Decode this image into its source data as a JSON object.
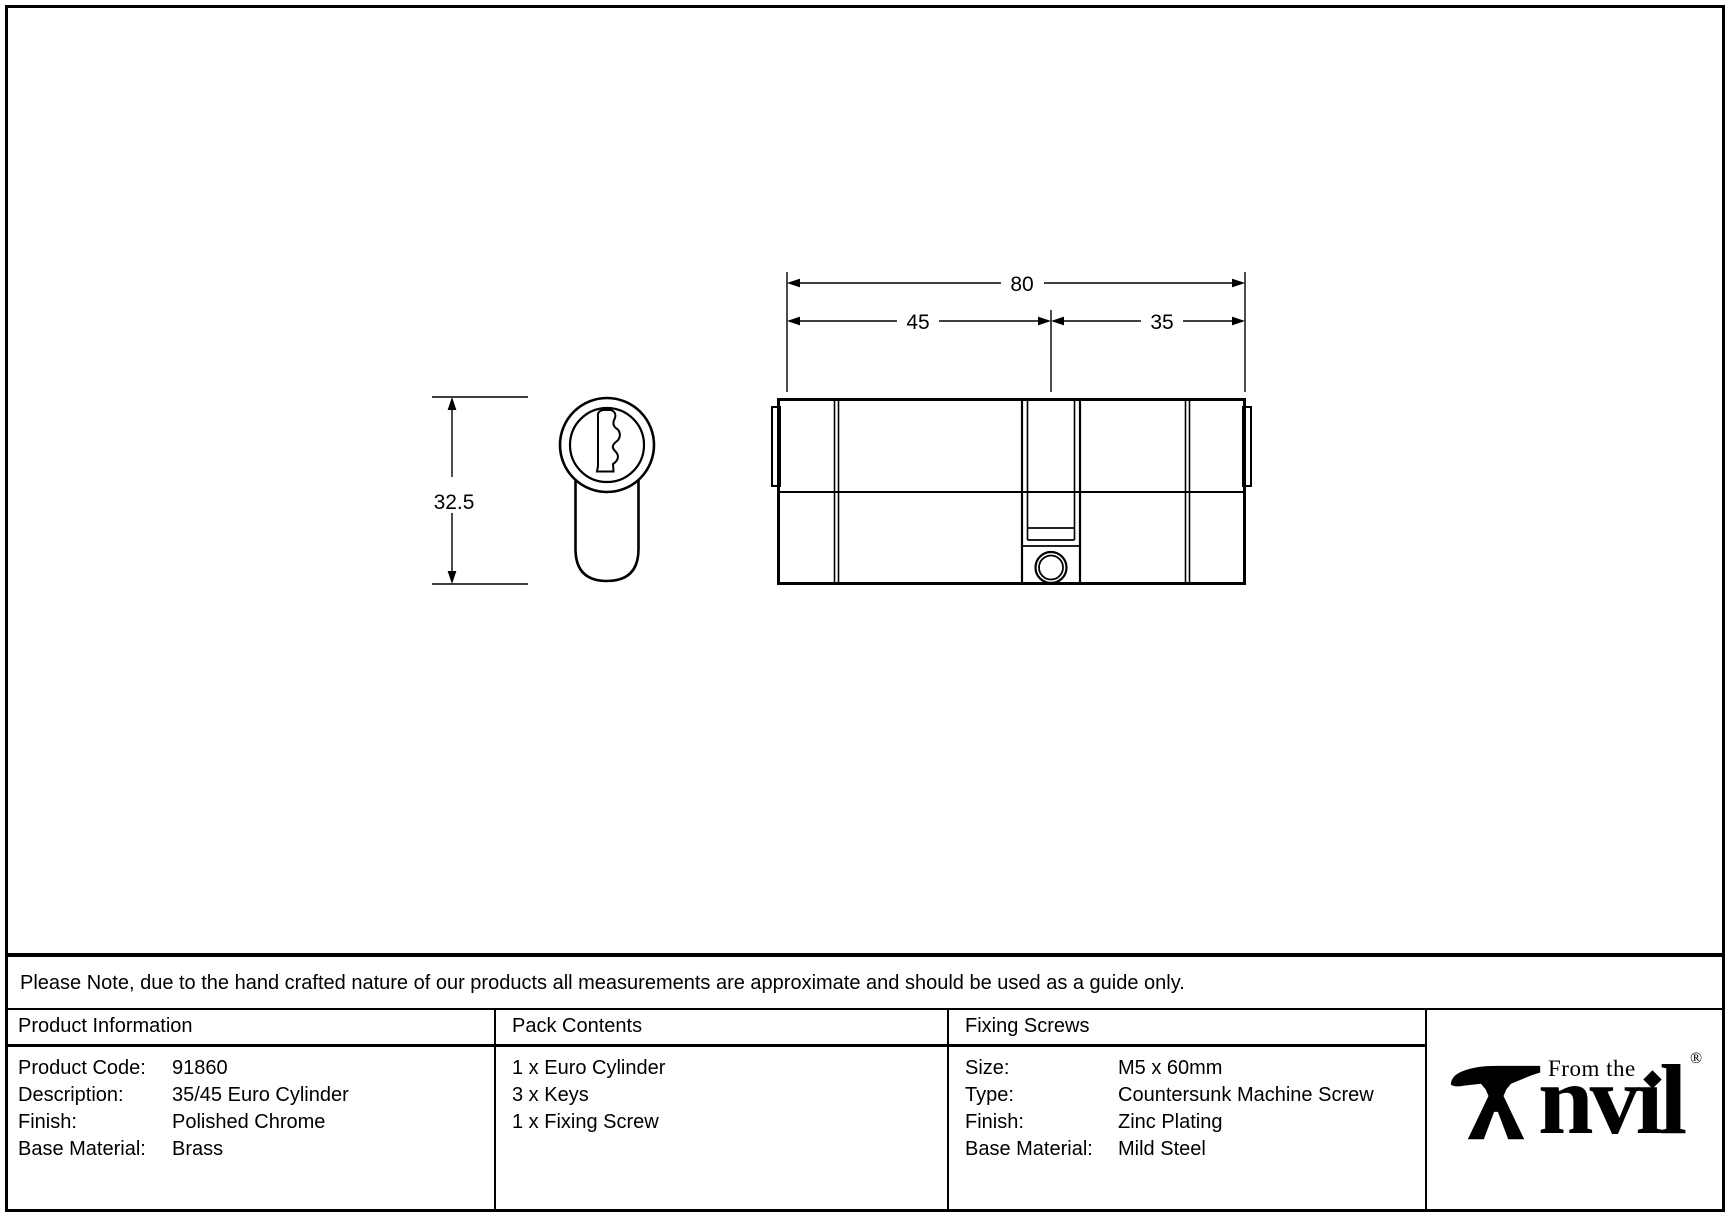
{
  "note": {
    "text": "Please Note, due to the hand crafted nature of our products all measurements are approximate and should be used as a guide only."
  },
  "drawing": {
    "dim_overall": "80",
    "dim_left": "45",
    "dim_right": "35",
    "dim_height": "32.5"
  },
  "product_information": {
    "title": "Product Information",
    "rows": [
      {
        "label": "Product Code:",
        "value": "91860"
      },
      {
        "label": "Description:",
        "value": "35/45 Euro Cylinder"
      },
      {
        "label": "Finish:",
        "value": "Polished Chrome"
      },
      {
        "label": "Base Material:",
        "value": "Brass"
      }
    ]
  },
  "pack_contents": {
    "title": "Pack Contents",
    "items": [
      "1 x Euro Cylinder",
      "3 x Keys",
      "1 x Fixing Screw"
    ]
  },
  "fixing_screws": {
    "title": "Fixing Screws",
    "rows": [
      {
        "label": "Size:",
        "value": "M5 x 60mm"
      },
      {
        "label": "Type:",
        "value": "Countersunk Machine Screw"
      },
      {
        "label": "Finish:",
        "value": "Zinc Plating"
      },
      {
        "label": "Base Material:",
        "value": "Mild Steel"
      }
    ]
  },
  "logo": {
    "tagline": "From the",
    "brand_text": "nvıl",
    "registered": "®"
  }
}
